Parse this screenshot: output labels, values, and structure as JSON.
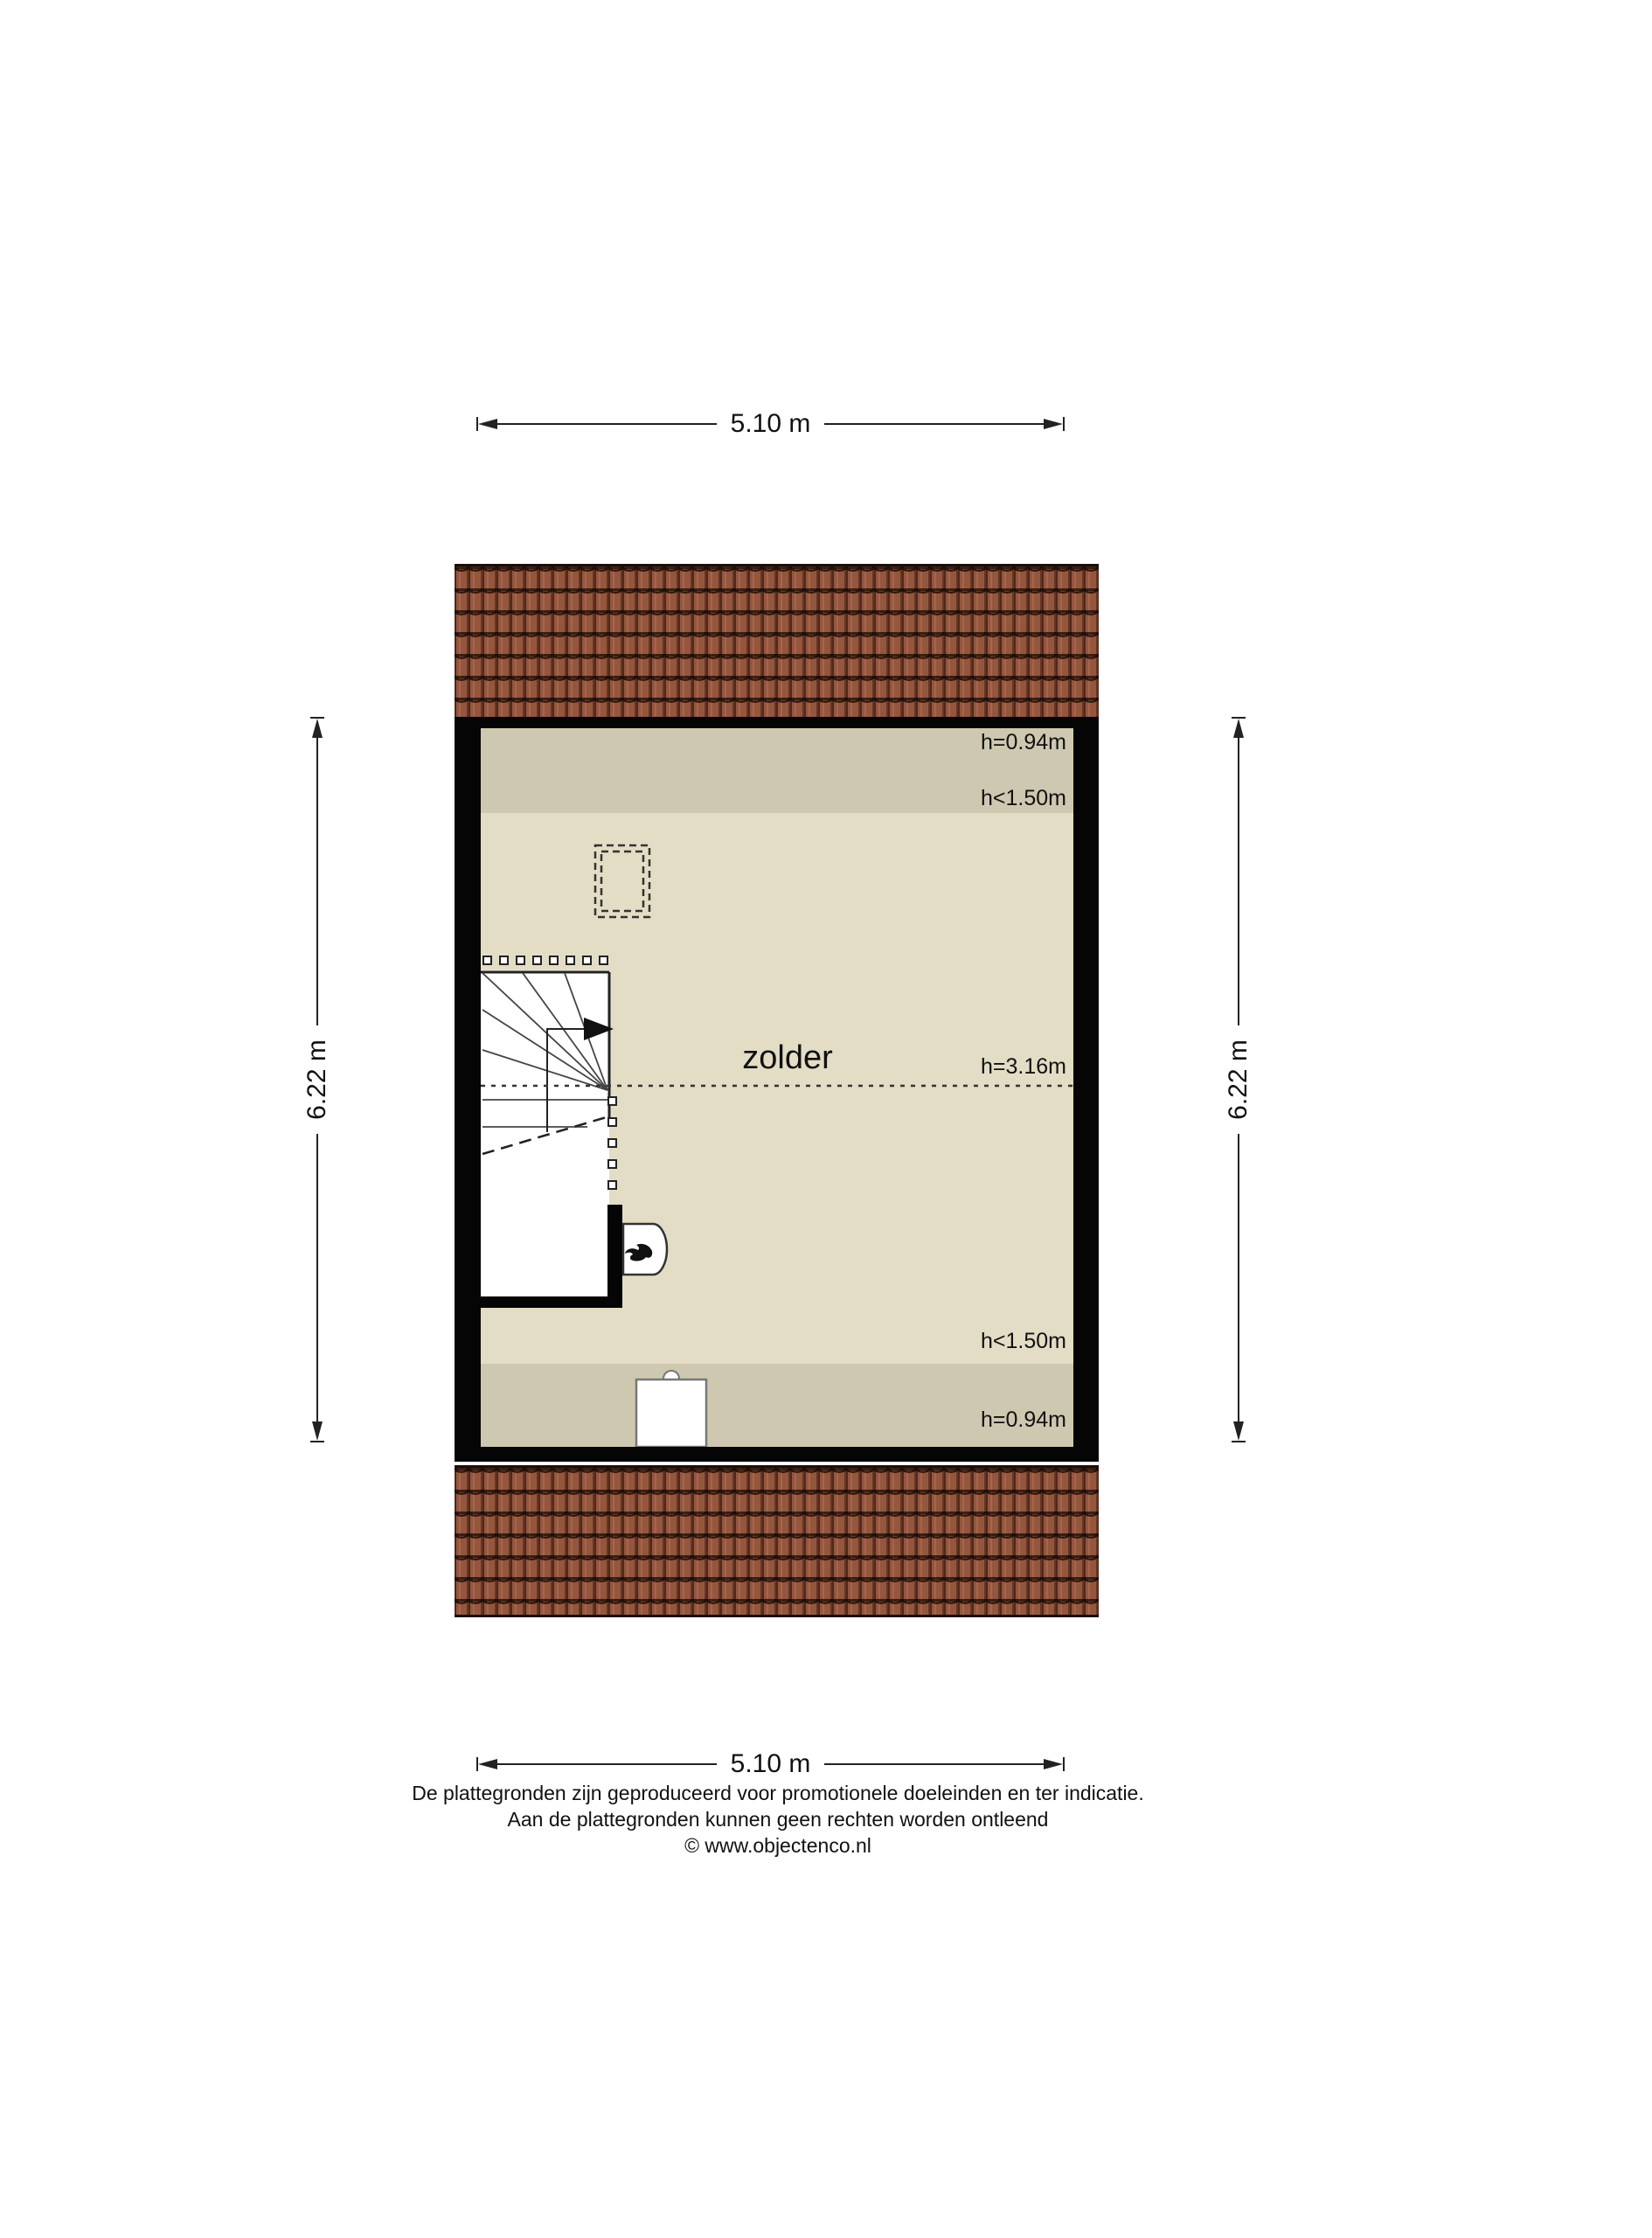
{
  "room": {
    "label": "zolder"
  },
  "dimensions": {
    "top": "5.10 m",
    "bottom": "5.10 m",
    "left": "6.22 m",
    "right": "6.22 m"
  },
  "heights": {
    "top_ridge": "h=0.94m",
    "top_band": "h<1.50m",
    "center": "h=3.16m",
    "bottom_band": "h<1.50m",
    "bottom_ridge": "h=0.94m"
  },
  "footer": {
    "line1": "De plattegronden zijn geproduceerd voor promotionele doeleinden en ter indicatie.",
    "line2": "Aan de plattegronden kunnen geen rechten worden ontleend",
    "line3": "© www.objectenco.nl"
  },
  "colors": {
    "roof_tile": "#95563e",
    "wall": "#050505",
    "floor_light": "#e3ddc5",
    "floor_low_headroom": "#cfc8b0"
  }
}
